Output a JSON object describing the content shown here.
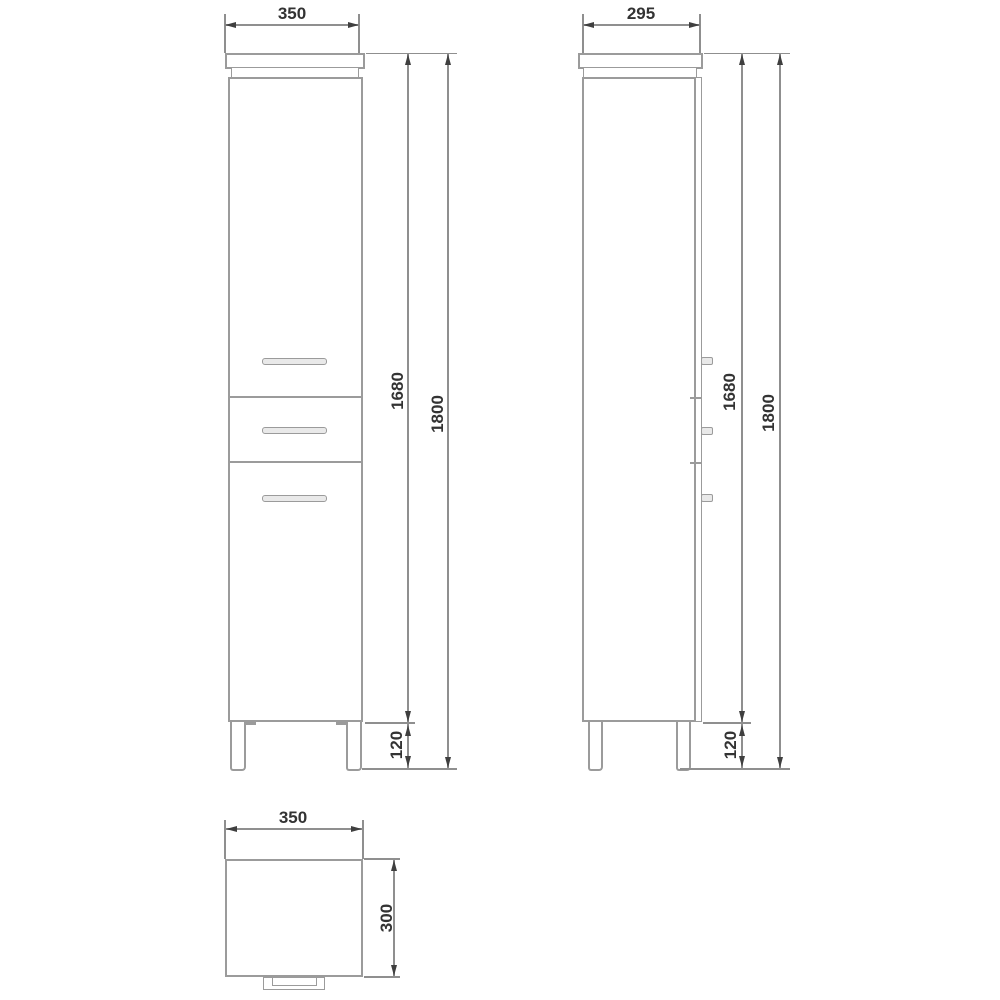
{
  "views": {
    "front": {
      "width": "350",
      "cabinet_height": "1680",
      "total_height": "1800",
      "leg_height": "120"
    },
    "side": {
      "depth": "295",
      "cabinet_height": "1680",
      "total_height": "1800",
      "leg_height": "120"
    },
    "plan": {
      "width": "350",
      "depth": "300"
    }
  },
  "colors": {
    "background": "#ffffff",
    "object_line": "#9b9b9b",
    "dim_line": "#8f8f8f",
    "arrow": "#3f3f3f",
    "text": "#333333",
    "handle_fill": "#e9e9e9"
  }
}
